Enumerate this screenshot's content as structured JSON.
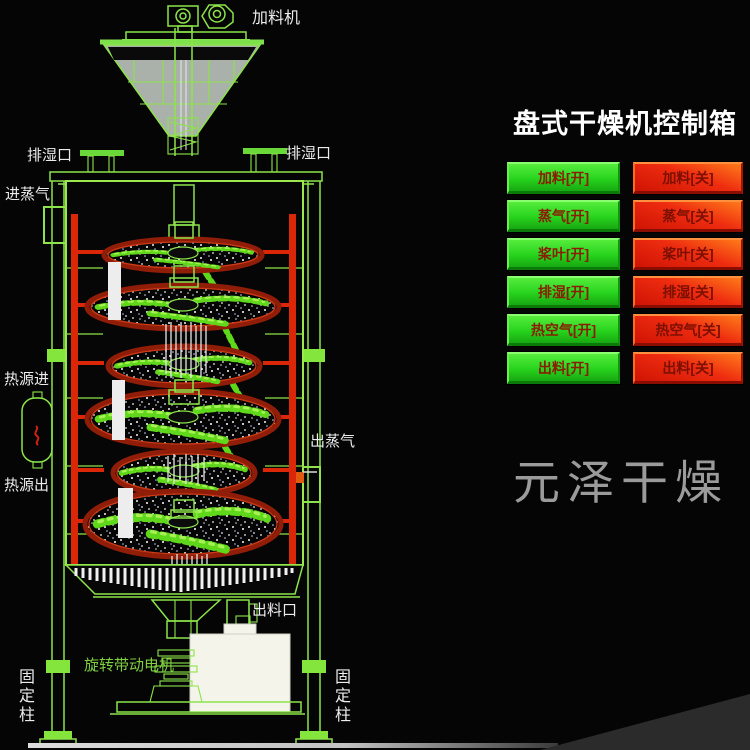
{
  "diagram": {
    "labels": {
      "feeder": "加料机",
      "vent_left": "排湿口",
      "vent_right": "排湿口",
      "steam_in": "进蒸气",
      "heat_source_in": "热源进",
      "heat_source_out": "热源出",
      "steam_out": "出蒸气",
      "discharge_port": "出料口",
      "drive_motor": "旋转带动电机",
      "fixed_column_left": "固定柱",
      "fixed_column_right": "固定柱"
    },
    "disc_count": 6
  },
  "control_panel": {
    "title": "盘式干燥机控制箱",
    "on_labels": [
      "加料[开]",
      "蒸气[开]",
      "桨叶[开]",
      "排湿[开]",
      "热空气[开]",
      "出料[开]"
    ],
    "off_labels": [
      "加料[关]",
      "蒸气[关]",
      "桨叶[关]",
      "排湿[关]",
      "热空气[关]",
      "出料[关]"
    ]
  },
  "watermark": "元泽干燥",
  "colors": {
    "background": "#050505",
    "line_green": "#8ce44a",
    "bright_green": "#7ae030",
    "pipe_red": "#dc2608",
    "disc_rim_red": "#8f1d08",
    "button_on_green": "#2bd81e",
    "button_off_red": "#e62a10",
    "button_text_dark_red": "#8b1c00",
    "panel_title": "#ffffff",
    "watermark_gray": "#9b9b9b"
  }
}
